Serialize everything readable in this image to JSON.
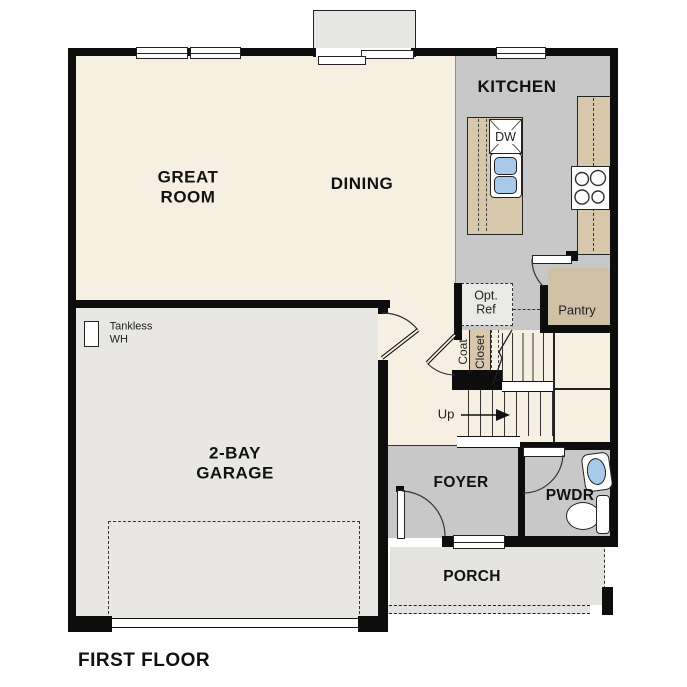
{
  "plan": {
    "title": "FIRST FLOOR",
    "rooms": {
      "great_room": "GREAT\nROOM",
      "dining": "DINING",
      "kitchen": "KITCHEN",
      "garage": "2-BAY\nGARAGE",
      "foyer": "FOYER",
      "powder": "PWDR",
      "porch": "PORCH",
      "pantry": "Pantry"
    },
    "annotations": {
      "opt_ref": "Opt.\nRef",
      "coat": "Coat",
      "closet": "Closet",
      "up": "Up",
      "tankless_wh": "Tankless\nWH",
      "dishwasher": "DW"
    },
    "colors": {
      "wall": "#0d0d0d",
      "floor_main": "#f7f0e2",
      "floor_kitchen": "#c8c8c8",
      "floor_garage": "#e8e7e3",
      "floor_porch": "#e4e3e0",
      "counter_tan": "#d7c8ab",
      "pantry_tan": "#cfc1a6",
      "sink_blue": "#a9c9e9",
      "fixture_white": "#ffffff"
    }
  }
}
